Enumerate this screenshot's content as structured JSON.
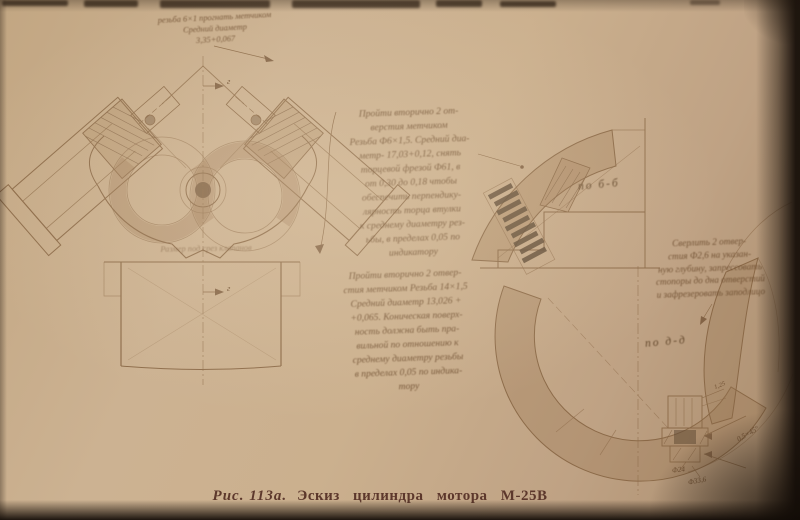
{
  "figure": {
    "caption_number": "Рис. 113а.",
    "caption_title": "Эскиз цилиндра мотора М-25В"
  },
  "annotations": {
    "thread_note": "резьба 6×1 прогнать метчиком\nСредний диаметр\n3,35+0,067",
    "retap_upper": "Пройти вторично 2 от-\nверстия метчиком\nРезьба Ф6×1,5. Средний диа-\nметр- 17,03+0,12, снять\nторцевой фрезой Ф61, в\nот 0,30 до 0,18 чтобы\nобеспечить перпендику-\nлярность торца втулки\nк среднему диаметру рез-\nьбы, в пределах 0,05 по\nиндикатору",
    "retap_lower": "Пройти вторично 2 отвер-\nстия метчиком Резьба 14×1,5\nСредний диаметр 13,026 +\n+0,065. Коническая поверх-\nность должна быть пра-\nвильной по отношению к\nсреднему диаметру резьбы\nв пределах 0,05 по индика-\nтору",
    "drill_stoppers": "Сверлить 2 отвер-\nстия Ф2,6 на указан-\nную глубину, запрессовать\nстопоры до дна отверстий\nи зафрезеровать заподлицо",
    "valve_size_note": "Размер под срез клапанов"
  },
  "section_labels": {
    "b": "по б-б",
    "d": "по д-д",
    "g": "г"
  },
  "dimensions": {
    "d24": "Ф24",
    "d336": "Ф33,6",
    "chamfer": "0,5×45°",
    "depth": "1,25"
  },
  "colors": {
    "paper": "#cbb08e",
    "ink": "#7a5a3c",
    "caption": "#5d382c",
    "edge": "#241a12"
  }
}
